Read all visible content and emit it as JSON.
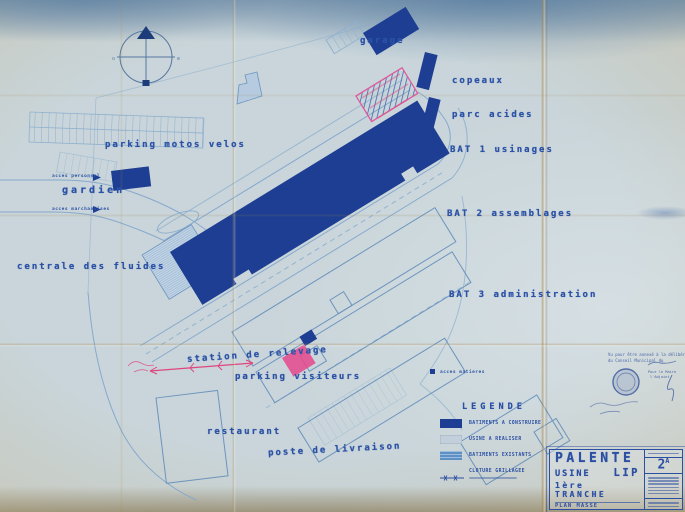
{
  "document": {
    "type": "scanned architectural site plan (blueprint)",
    "sheet_title": "PALENTE USINE LIP 1ère TRANCHE",
    "drawing_name": "PLAN MASSE",
    "sheet_number": "2A"
  },
  "labels": [
    {
      "text": "garage"
    },
    {
      "text": "copeaux"
    },
    {
      "text": "parc acides"
    },
    {
      "text": "BAT 1 usinages"
    },
    {
      "text": "BAT 2 assemblages"
    },
    {
      "text": "BAT 3 administration"
    },
    {
      "text": "parking motos velos"
    },
    {
      "text": "gardien"
    },
    {
      "text": "centrale des fluides"
    },
    {
      "text": "station de relevage"
    },
    {
      "text": "parking visiteurs"
    },
    {
      "text": "restaurant"
    },
    {
      "text": "poste de livraison"
    },
    {
      "text": "acces personnel"
    },
    {
      "text": "acces marchandises"
    },
    {
      "text": "acces matieres"
    }
  ],
  "legend": {
    "title": "LEGENDE",
    "items": [
      {
        "label": "BATIMENTS A CONSTRUIRE",
        "swatch": "solid-dark-blue"
      },
      {
        "label": "USINE A REALISER",
        "swatch": "pale-blue"
      },
      {
        "label": "BATIMENTS EXISTANTS",
        "swatch": "striped-blue"
      },
      {
        "label": "CLOTURE GRILLAGEE",
        "swatch": "fence-line"
      }
    ]
  },
  "title_block": {
    "project": "PALENTE",
    "usine": "USINE",
    "lip": "LIP",
    "tranche": "1ère TRANCHE",
    "plan_type": "PLAN MASSE",
    "sheet_number": "2",
    "sheet_sup": "A"
  },
  "stamp": {
    "line1": "Vu pour être annexé à la délibération",
    "line2": "du Conseil Municipal du",
    "maire1": "Pour le Maire",
    "maire2": "l'Adjoint"
  },
  "colors": {
    "buildings_new": "#1d3e92",
    "buildings_existing": "#5e90c6",
    "plan_lines": "#86a9cc",
    "label_ink": "#2c52a6",
    "crayon_pink": "#e0457f",
    "paper": "#c9d5da",
    "fold_tan": "#c4a86e"
  }
}
